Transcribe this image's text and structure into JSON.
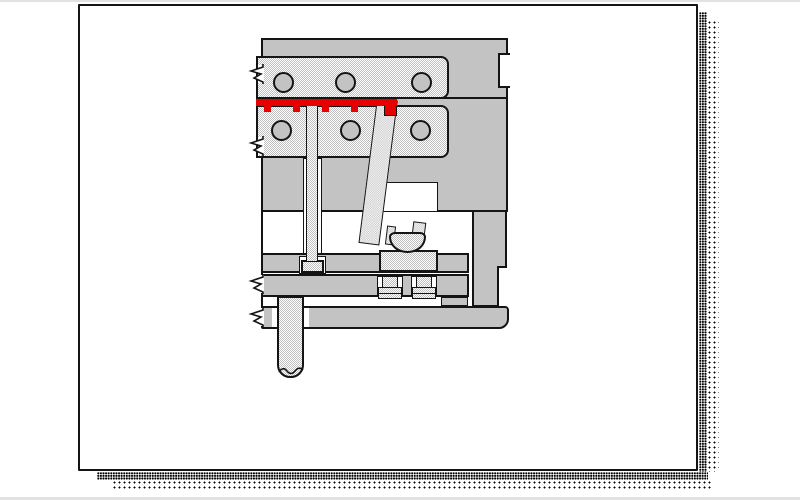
{
  "canvas": {
    "width": 800,
    "height": 500,
    "background": "#ffffff"
  },
  "page": {
    "background": "#ffffff",
    "border_color": "#141414",
    "shadow_style": "stippled black dots along right and bottom edges"
  },
  "diagram": {
    "type": "technical-illustration",
    "subject": "Cross-section of an injection mold ejection system with angled lifter, ejector pin and ejector plates",
    "text_labels": [],
    "colors": {
      "plate_gray": "#c3c3c3",
      "insert_dither": "#bfbfbf checker on #ffffff",
      "outline": "#141414",
      "molded_part_red": "#e60000",
      "clearance_white": "#ffffff"
    },
    "parts": [
      {
        "name": "top-clamp-plate",
        "fill": "plate_gray",
        "note": "upper gray block with notch on right edge"
      },
      {
        "name": "parting-line",
        "fill": "outline"
      },
      {
        "name": "cavity-insert",
        "fill": "insert_dither",
        "holes": 3
      },
      {
        "name": "core-insert",
        "fill": "insert_dither",
        "holes": 3
      },
      {
        "name": "molded-part",
        "fill": "molded_part_red",
        "ribs": 4,
        "boss_step_right": true
      },
      {
        "name": "b-side-block",
        "fill": "plate_gray"
      },
      {
        "name": "lifter-clearance-slot",
        "fill": "clearance_white"
      },
      {
        "name": "ejector-pin",
        "fill": "insert_dither"
      },
      {
        "name": "ejector-pin-head",
        "fill": "insert_dither"
      },
      {
        "name": "angled-lifter-pin",
        "fill": "insert_dither",
        "angle_deg": 7.3
      },
      {
        "name": "lifter-foot",
        "fill": "insert_dither"
      },
      {
        "name": "lifter-slide-block",
        "fill": "insert_dither"
      },
      {
        "name": "ejector-retainer-plate",
        "fill": "plate_gray"
      },
      {
        "name": "ejector-base-plate",
        "fill": "plate_gray"
      },
      {
        "name": "shoulder-bolt",
        "count": 2,
        "fill": "insert_dither"
      },
      {
        "name": "rest-pad",
        "fill": "plate_gray"
      },
      {
        "name": "support-rail",
        "fill": "plate_gray"
      },
      {
        "name": "bottom-clamp-plate",
        "fill": "plate_gray",
        "rounded_right_corner": true
      },
      {
        "name": "ejector-rod",
        "fill": "insert_dither",
        "break_mark": true
      },
      {
        "name": "break-mark-zigzag",
        "count": 4,
        "positions": "left edges of insert plates, ejector base plate, bottom clamp plate"
      }
    ]
  }
}
